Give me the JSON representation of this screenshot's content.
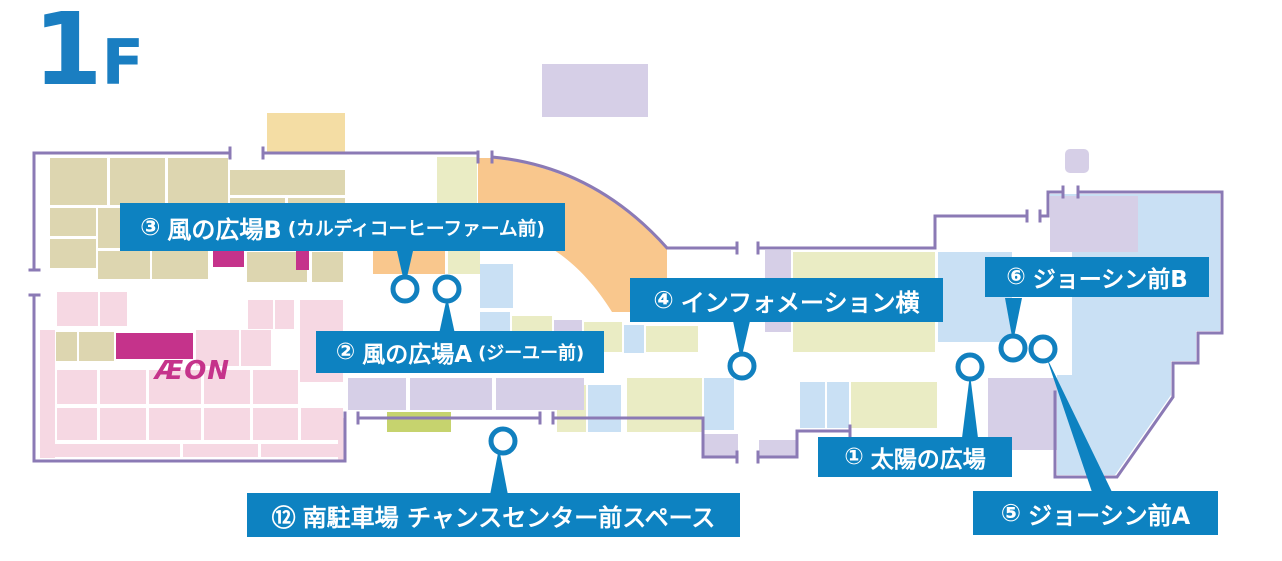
{
  "floor": {
    "number": "1",
    "suffix": "F"
  },
  "store_logo": "ÆON",
  "labels": [
    {
      "id": 3,
      "badge": "③",
      "title": "風の広場B",
      "note": "(カルディコーヒーファーム前)"
    },
    {
      "id": 2,
      "badge": "②",
      "title": "風の広場A",
      "note": "(ジーユー前)"
    },
    {
      "id": 4,
      "badge": "④",
      "title": "インフォメーション横",
      "note": ""
    },
    {
      "id": 6,
      "badge": "⑥",
      "title": "ジョーシン前B",
      "note": ""
    },
    {
      "id": 1,
      "badge": "①",
      "title": "太陽の広場",
      "note": ""
    },
    {
      "id": 5,
      "badge": "⑤",
      "title": "ジョーシン前A",
      "note": ""
    },
    {
      "id": 12,
      "badge": "⑫",
      "title": "南駐車場 チャンスセンター前スペース",
      "note": ""
    }
  ],
  "markers": [
    {
      "spot": 3
    },
    {
      "spot": 2
    },
    {
      "spot": 4
    },
    {
      "spot": 12
    },
    {
      "spot": 1
    },
    {
      "spot": 6
    },
    {
      "spot": 5
    }
  ],
  "palette": {
    "label_bg": "#0d82c1",
    "outline": "#8b7ab5",
    "marker_ring": "#1180bf",
    "title_blue": "#1a7ec1",
    "aeon_magenta": "#c5338b",
    "pink": "#f6d8e3",
    "tan": "#ddd6b0",
    "orange": "#f9c78d",
    "yellow": "#f4dda4",
    "yellow_green": "#eaecc4",
    "green": "#c6d36e",
    "light_blue": "#c9e0f4",
    "lavender": "#d6cfe7"
  }
}
